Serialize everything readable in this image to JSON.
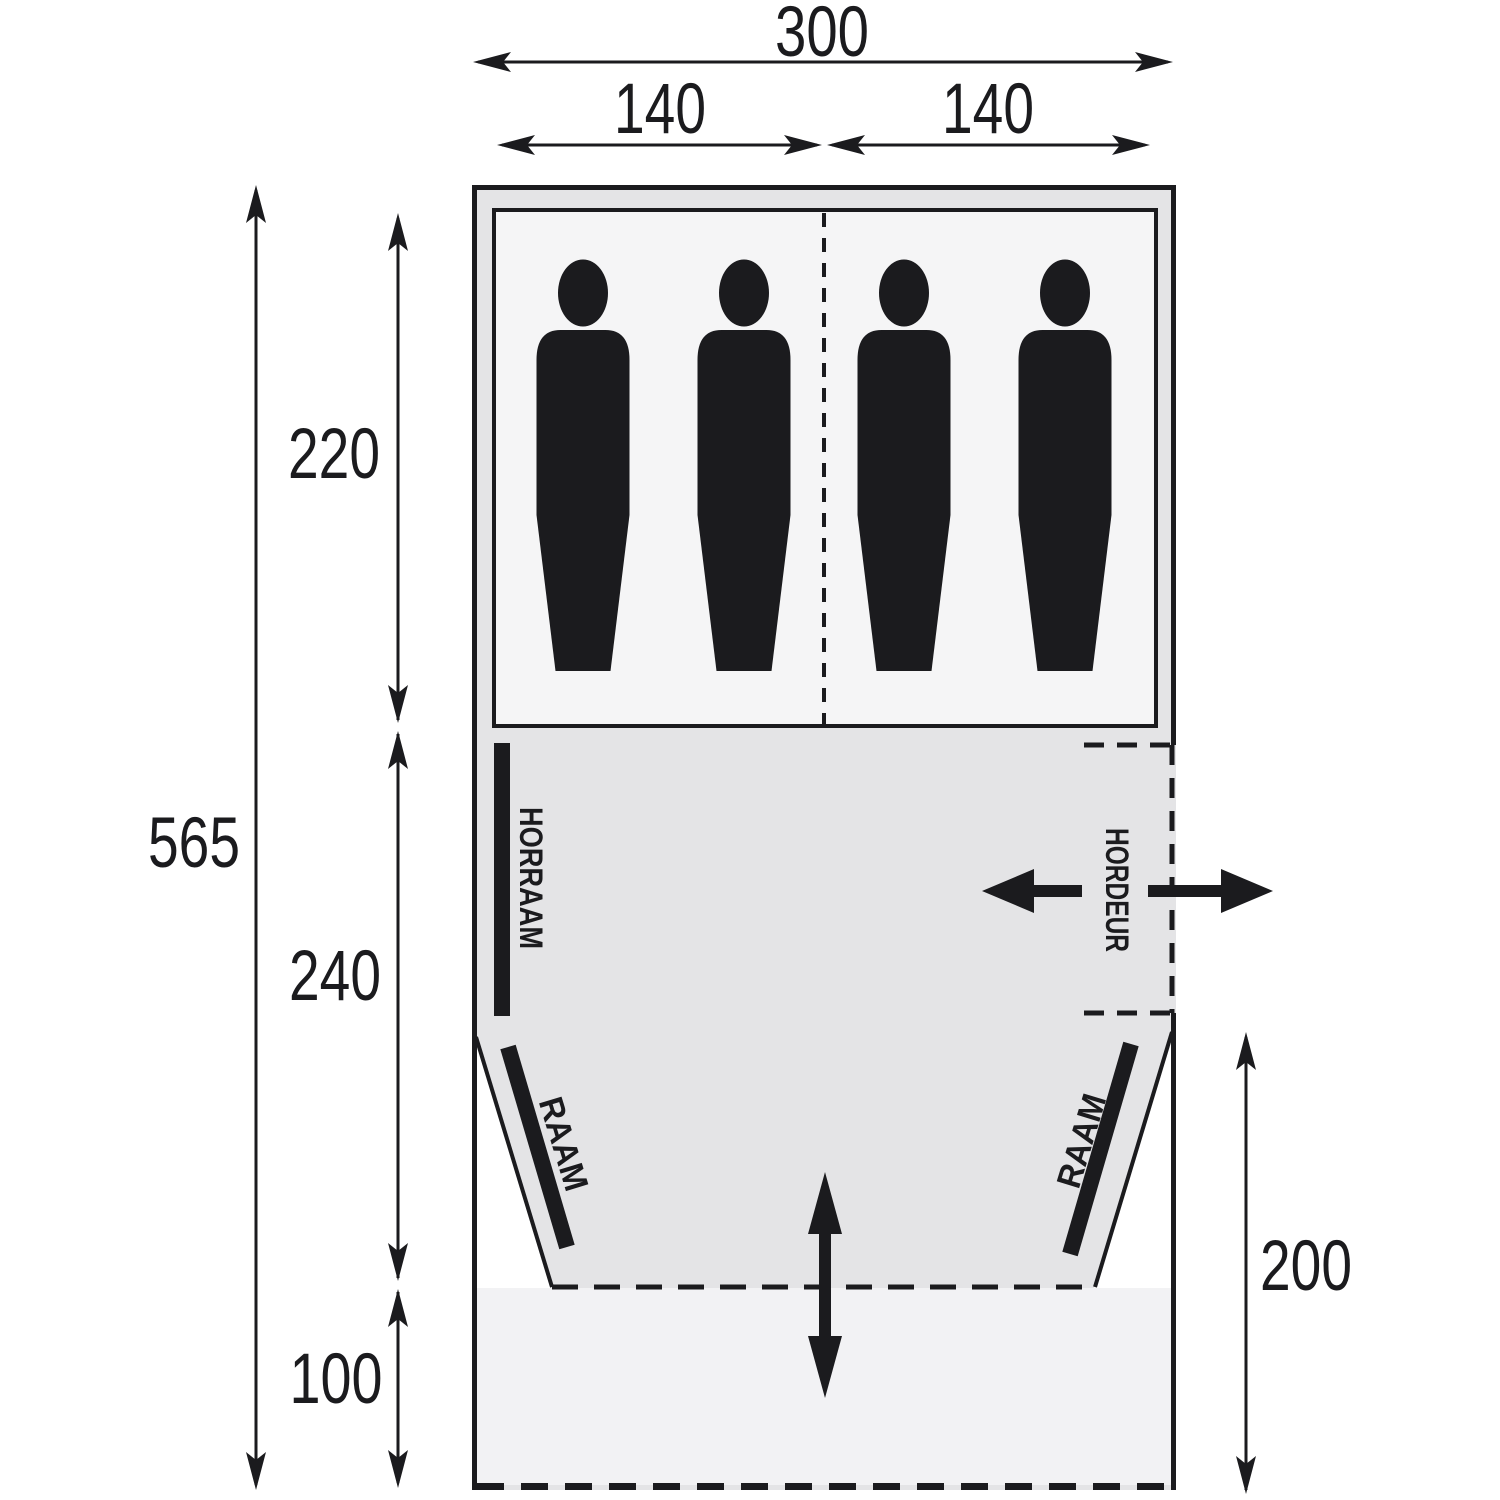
{
  "diagram": {
    "dimensions": {
      "total_width": "300",
      "left_half_width": "140",
      "right_half_width": "140",
      "total_depth": "565",
      "sleeping_cabin_depth": "220",
      "living_area_depth": "240",
      "canopy_depth": "100",
      "side_door_depth": "200"
    },
    "labels": {
      "screen_window": "HORRAAM",
      "screen_door": "HORDEUR",
      "left_window": "RAAM",
      "right_window": "RAAM"
    },
    "sleeping_capacity": 4,
    "colors": {
      "line": "#1b1b1e",
      "tent_fill": "#e4e4e6",
      "cabin_fill": "#f5f5f6",
      "front_fill": "#f2f2f4",
      "background": "#ffffff"
    }
  }
}
